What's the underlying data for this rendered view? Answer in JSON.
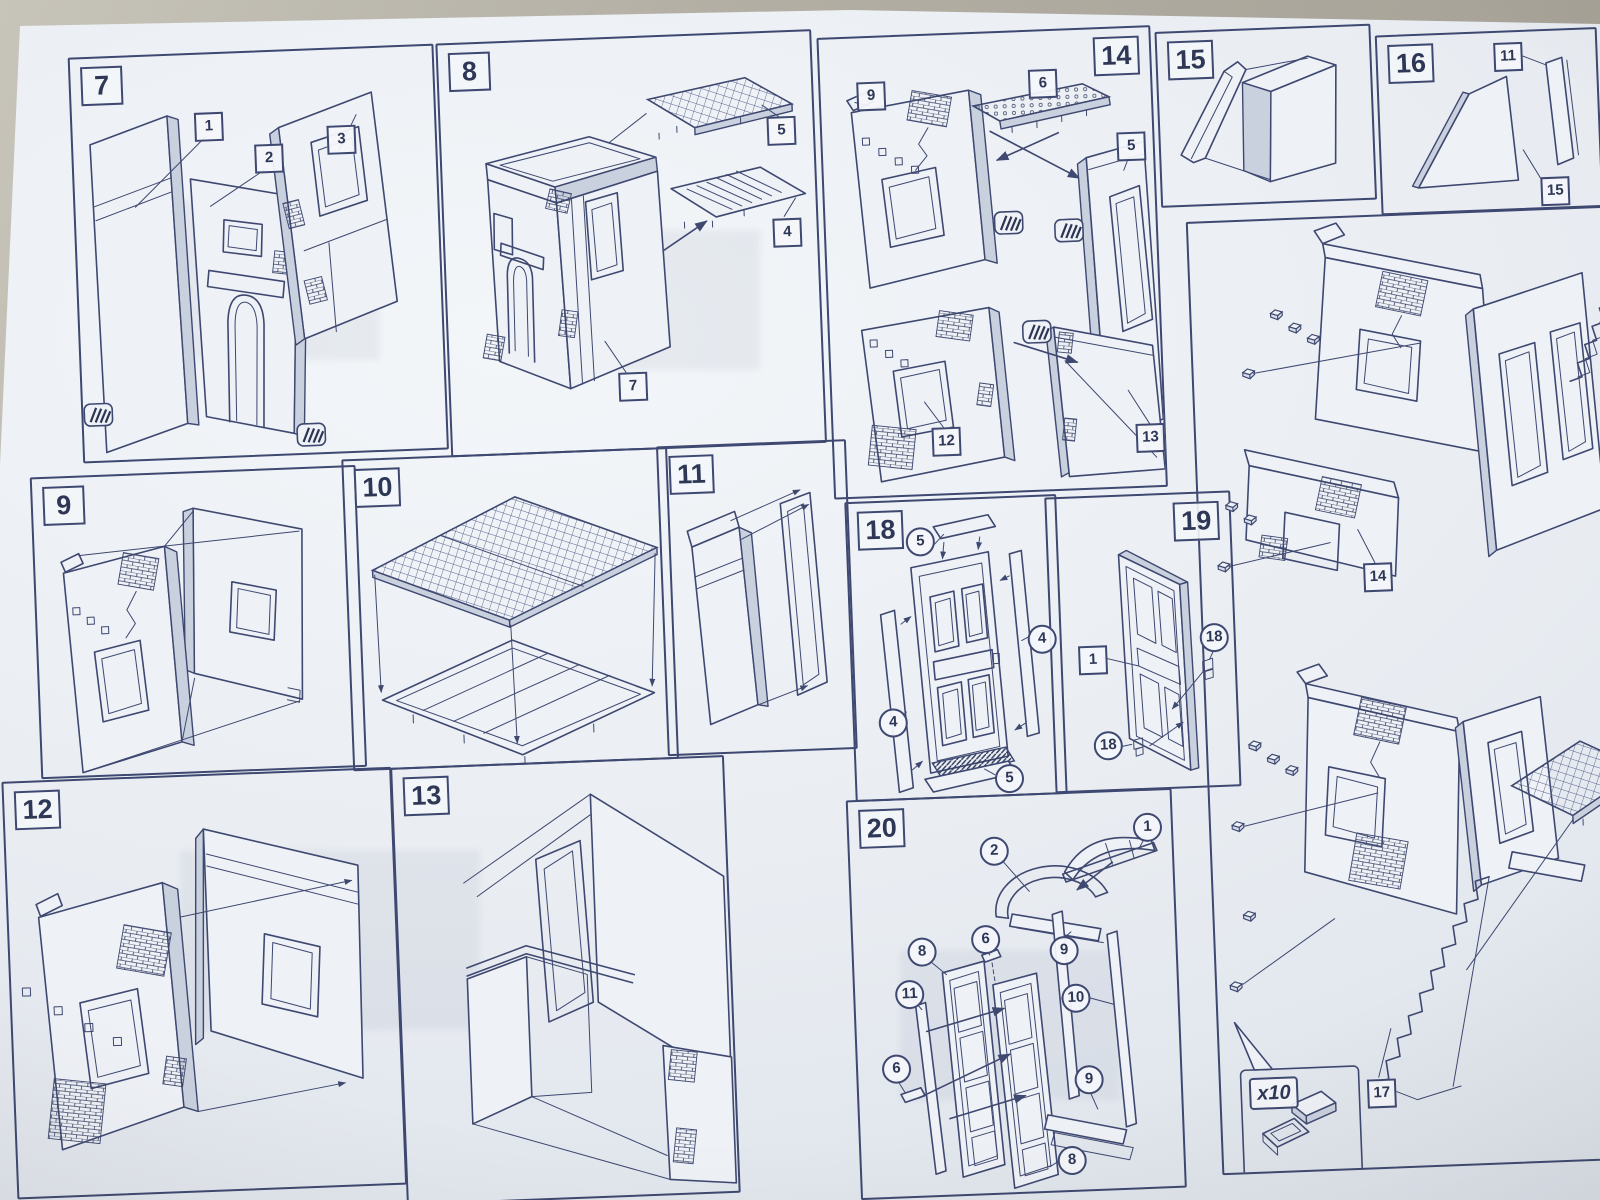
{
  "photo": {
    "background_color": "#b1ada2",
    "paper_color": "#eaeef3",
    "ink_color": "#3e4870"
  },
  "icons": {
    "glue_dab": "glue-hatch-icon",
    "assembly_arrow": "arrow-icon",
    "quantity_detail": "peg-detail-icon"
  },
  "panels": {
    "step7": {
      "number": "7",
      "callouts": [
        {
          "shape": "square",
          "label": "1"
        },
        {
          "shape": "square",
          "label": "2"
        },
        {
          "shape": "square",
          "label": "3"
        }
      ]
    },
    "step8": {
      "number": "8",
      "callouts": [
        {
          "shape": "square",
          "label": "5"
        },
        {
          "shape": "square",
          "label": "4"
        },
        {
          "shape": "square",
          "label": "7"
        }
      ]
    },
    "step9": {
      "number": "9",
      "callouts": []
    },
    "step10": {
      "number": "10",
      "callouts": []
    },
    "step11": {
      "number": "11",
      "callouts": []
    },
    "step12": {
      "number": "12",
      "callouts": []
    },
    "step13": {
      "number": "13",
      "callouts": []
    },
    "step14": {
      "number": "14",
      "callouts": [
        {
          "shape": "square",
          "label": "9"
        },
        {
          "shape": "square",
          "label": "6"
        },
        {
          "shape": "square",
          "label": "5"
        },
        {
          "shape": "square",
          "label": "12"
        },
        {
          "shape": "square",
          "label": "13"
        }
      ]
    },
    "step15": {
      "number": "15",
      "callouts": []
    },
    "step16": {
      "number": "16",
      "callouts": [
        {
          "shape": "square",
          "label": "11"
        },
        {
          "shape": "square",
          "label": "15"
        }
      ]
    },
    "step18": {
      "number": "18",
      "callouts": [
        {
          "shape": "circle",
          "label": "5"
        },
        {
          "shape": "circle",
          "label": "4"
        },
        {
          "shape": "circle",
          "label": "4"
        },
        {
          "shape": "circle",
          "label": "5"
        }
      ]
    },
    "step19": {
      "number": "19",
      "callouts": [
        {
          "shape": "square",
          "label": "1"
        },
        {
          "shape": "circle",
          "label": "18"
        },
        {
          "shape": "circle",
          "label": "18"
        }
      ]
    },
    "step20": {
      "number": "20",
      "callouts": [
        {
          "shape": "circle",
          "label": "2"
        },
        {
          "shape": "circle",
          "label": "1"
        },
        {
          "shape": "circle",
          "label": "9"
        },
        {
          "shape": "circle",
          "label": "6"
        },
        {
          "shape": "circle",
          "label": "8"
        },
        {
          "shape": "circle",
          "label": "11"
        },
        {
          "shape": "circle",
          "label": "10"
        },
        {
          "shape": "circle",
          "label": "6"
        },
        {
          "shape": "circle",
          "label": "9"
        },
        {
          "shape": "circle",
          "label": "8"
        }
      ]
    },
    "assembly17": {
      "callouts": [
        {
          "shape": "square",
          "label": "14"
        },
        {
          "shape": "square",
          "label": "17"
        }
      ],
      "quantity_label": "x10"
    }
  }
}
